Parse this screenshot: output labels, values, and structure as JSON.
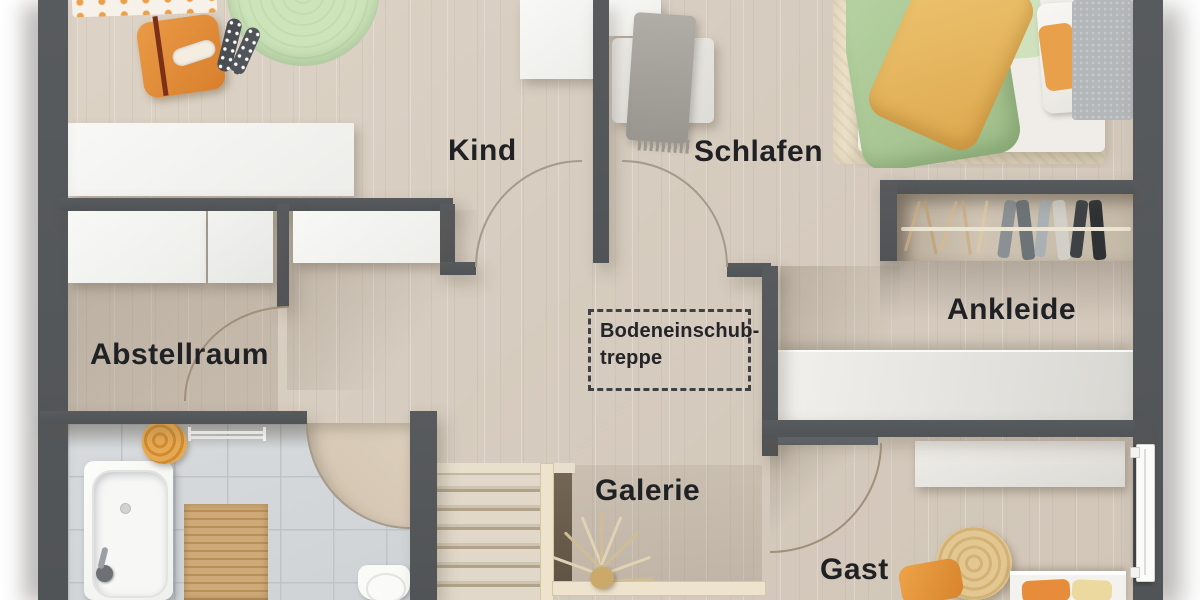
{
  "labels": {
    "kind": "Kind",
    "schlafen": "Schlafen",
    "abstellraum": "Abstellraum",
    "ankleide": "Ankleide",
    "galerie": "Galerie",
    "gast": "Gast"
  },
  "annotation": {
    "attic_stairs_line1": "Bodeneinschub-",
    "attic_stairs_line2": "treppe"
  },
  "colors": {
    "wall": "#54575a",
    "floor_wood": "#d8cec1",
    "floor_shadowed": "#c8bcad",
    "bath_tile": "#d4d7d9",
    "tile_grout": "#bfc4c7",
    "white_furniture": "#f4f4f2",
    "accent_orange": "#e08a38",
    "duvet_green": "#a9c795",
    "duvet_yellow": "#e6b763",
    "rug_green": "#cde4bb",
    "rug_cream": "#ede3cb",
    "wood_mat": "#c9a26e",
    "stair_wood": "#ddd3c5",
    "railing_wood": "#eee3cd",
    "label_text": "#1f2124"
  }
}
